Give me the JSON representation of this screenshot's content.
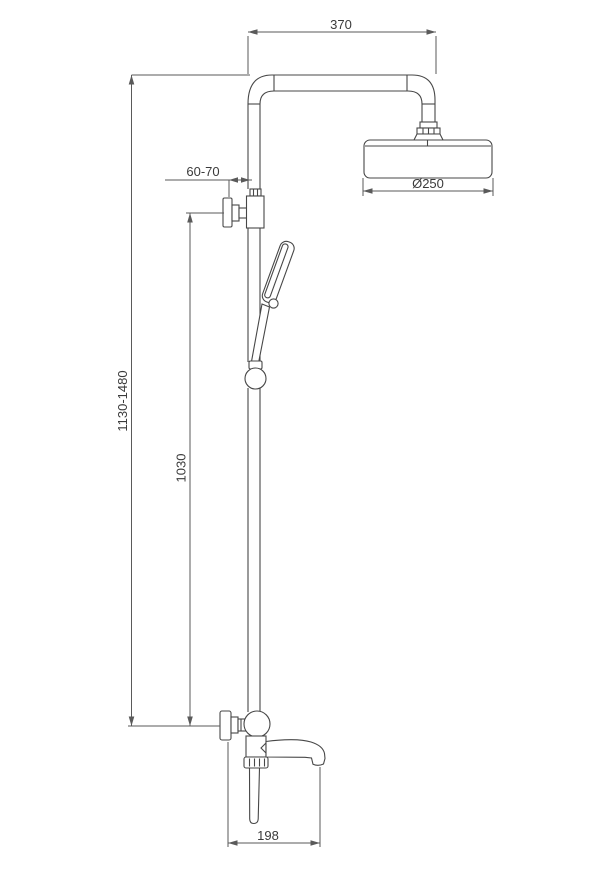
{
  "drawing": {
    "type": "shower-system-installation-dimension-drawing",
    "background": "#ffffff",
    "line_color": "#474747",
    "dimension_line_color": "#5a5a5a",
    "text_color": "#3a3a3a",
    "dimensions": {
      "arm_length": "370",
      "wall_clearance": "60-70",
      "head_diameter": "Ø250",
      "overall_height_range": "1130-1480",
      "riser_height": "1030",
      "spout_reach": "198"
    }
  }
}
